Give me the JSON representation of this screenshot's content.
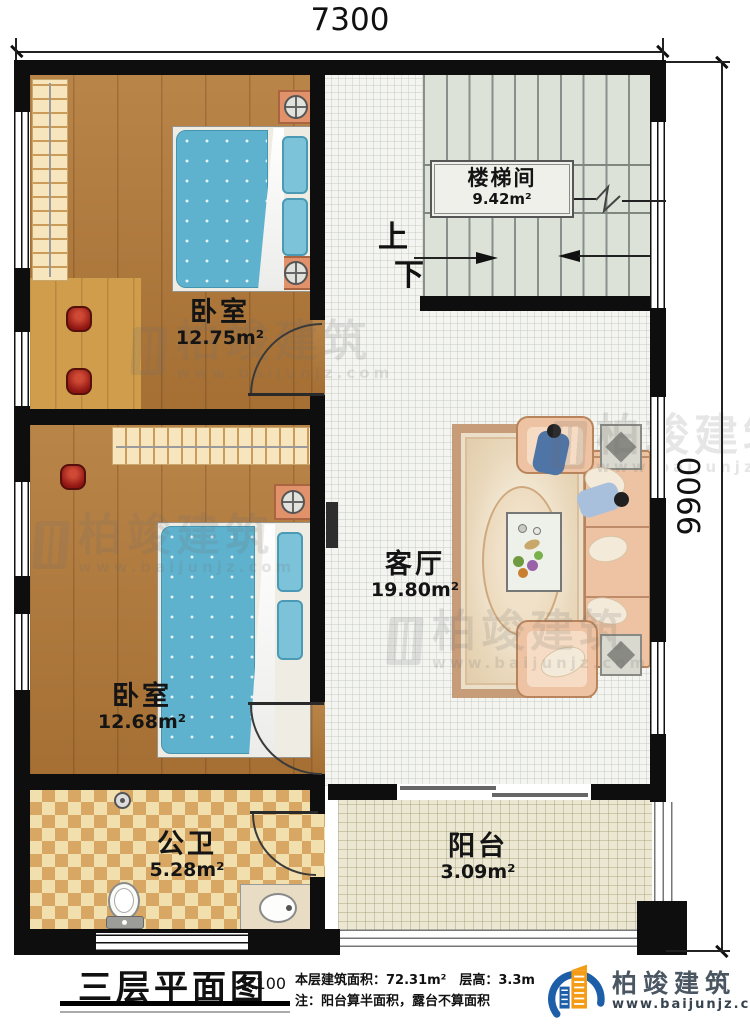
{
  "dimensions": {
    "top": "7300",
    "right": "9900"
  },
  "rooms": {
    "stairwell": {
      "name": "楼梯间",
      "area": "9.42m²"
    },
    "bedroom_top": {
      "name": "卧室",
      "area": "12.75m²"
    },
    "bedroom_bottom": {
      "name": "卧室",
      "area": "12.68m²"
    },
    "living_room": {
      "name": "客厅",
      "area": "19.80m²"
    },
    "bathroom": {
      "name": "公卫",
      "area": "5.28m²"
    },
    "balcony": {
      "name": "阳台",
      "area": "3.09m²"
    }
  },
  "stairs": {
    "up_label": "上",
    "down_label": "下"
  },
  "title_block": {
    "title": "三层平面图",
    "scale": "1:100",
    "floor_info": "本层建筑面积：72.31m²　层高：3.3m",
    "note": "注：阳台算半面积，露台不算面积"
  },
  "brand": {
    "name": "柏竣建筑",
    "website": "www.baijunjz.com"
  },
  "watermark": {
    "name": "柏竣建筑",
    "website": "www.baijunjz.com"
  },
  "colors": {
    "wall": "#0e0e0e",
    "accent_blue": "#1d5ea8",
    "accent_orange": "#f59c17",
    "wood": "#b1793a"
  }
}
